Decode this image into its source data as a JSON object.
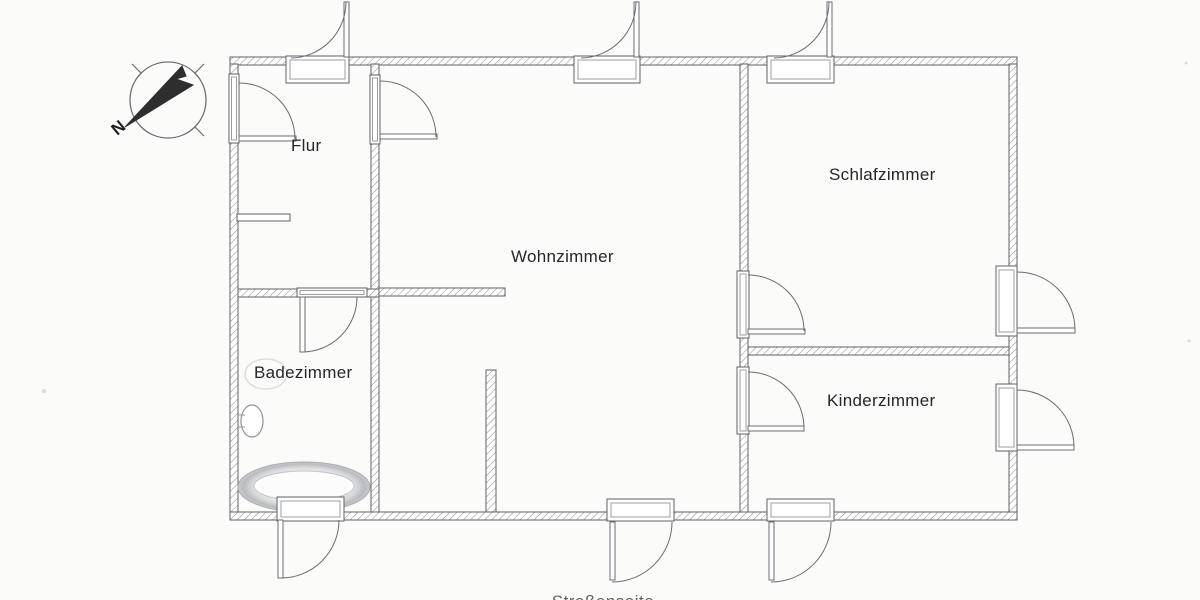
{
  "document": {
    "kind": "scanned apartment floor plan",
    "language": "de"
  },
  "compass": {
    "north_label": "N",
    "icon": "north-arrow-compass-icon"
  },
  "rooms": [
    {
      "id": "flur",
      "label": "Flur"
    },
    {
      "id": "wohnzimmer",
      "label": "Wohnzimmer"
    },
    {
      "id": "schlafzimmer",
      "label": "Schlafzimmer"
    },
    {
      "id": "badezimmer",
      "label": "Badezimmer"
    },
    {
      "id": "kinderzimmer",
      "label": "Kinderzimmer"
    }
  ],
  "caption": {
    "text": "Straßenseite"
  },
  "fixtures": [
    {
      "id": "bathtub-icon",
      "room": "badezimmer"
    },
    {
      "id": "washbasin-icon",
      "room": "badezimmer"
    },
    {
      "id": "toilet-outline-icon",
      "room": "badezimmer"
    }
  ],
  "colors": {
    "paper": "#fbfbfa",
    "wall_line": "#5f6264",
    "wall_hatch": "#8f9294",
    "door_line": "#6a6d70",
    "text": "#26262a",
    "fixture_shade": "#c3c6ca"
  }
}
